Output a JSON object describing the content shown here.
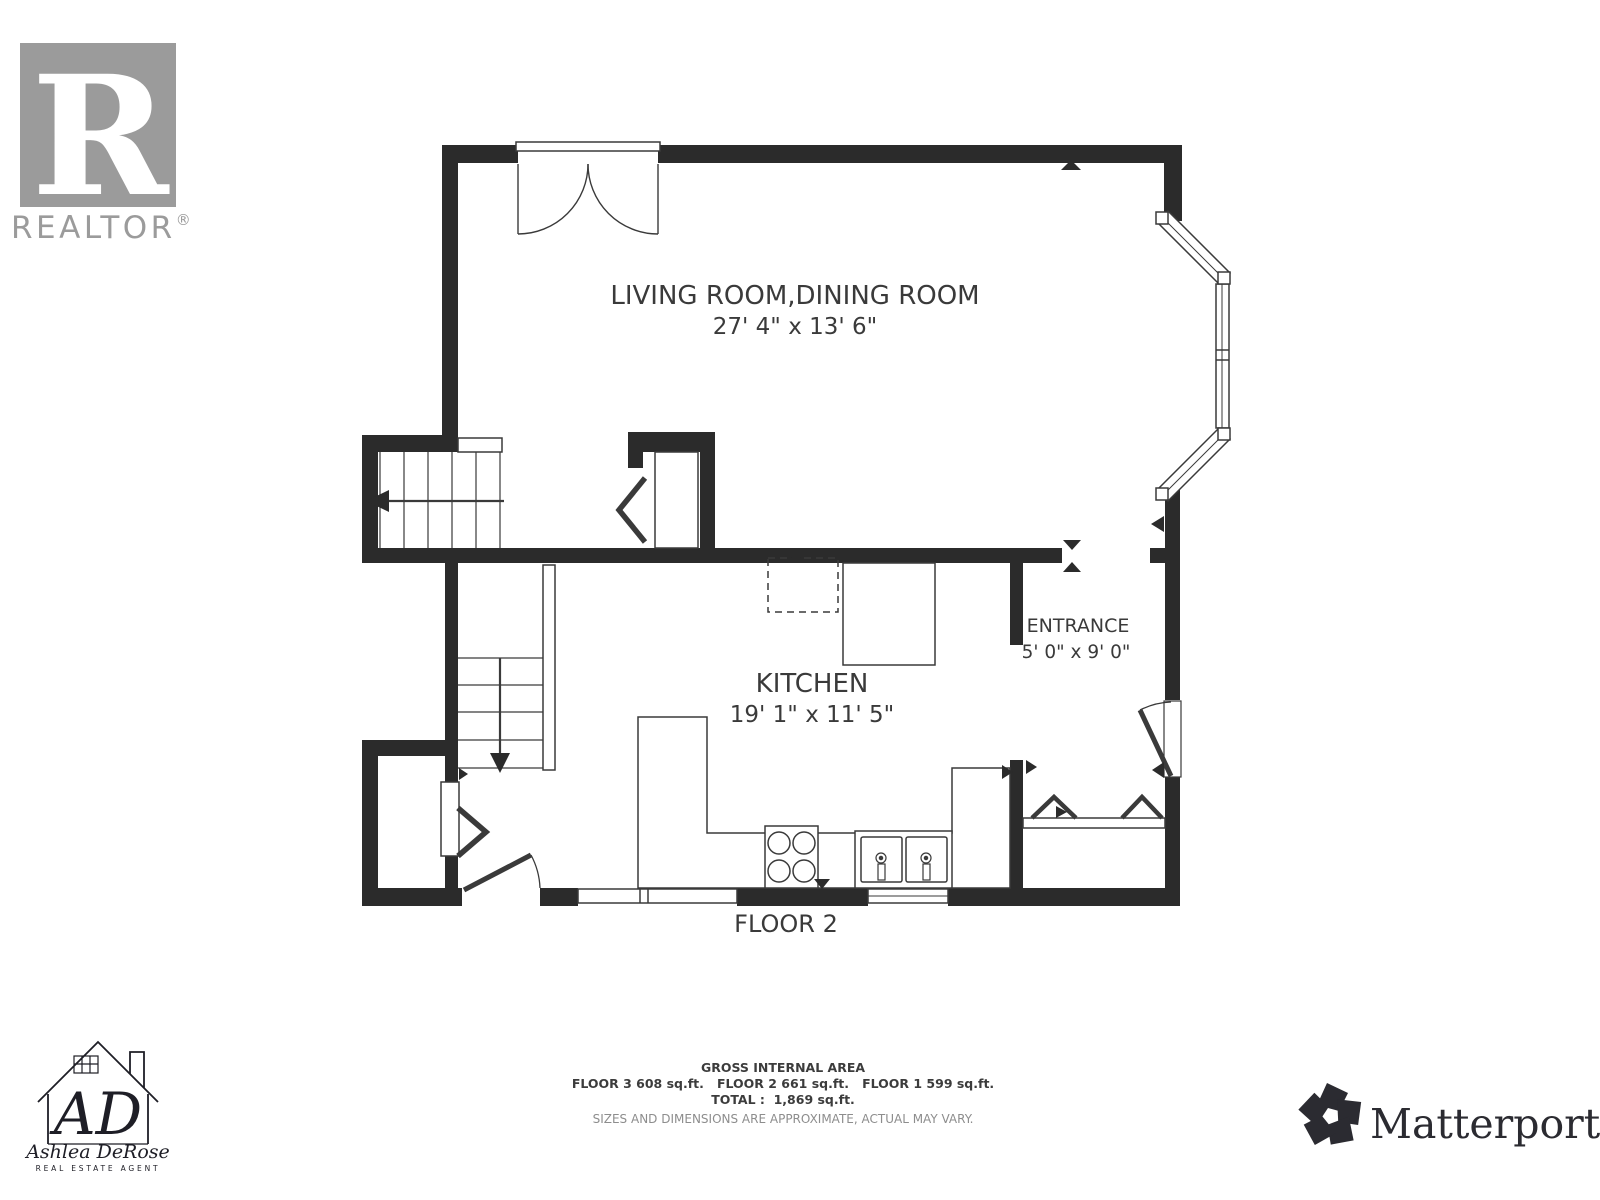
{
  "branding": {
    "realtor": {
      "mark_letter": "R",
      "wordmark": "REALTOR",
      "registered": "®"
    },
    "matterport": {
      "wordmark": "Matterport",
      "registered": "®"
    },
    "agent": {
      "monogram": "AD",
      "name": "Ashlea DeRose",
      "title": "REAL ESTATE AGENT"
    }
  },
  "floorplan": {
    "rooms": [
      {
        "name": "LIVING ROOM,DINING ROOM",
        "dimensions": "27' 4\" x 13' 6\""
      },
      {
        "name": "KITCHEN",
        "dimensions": "19' 1\" x 11' 5\""
      },
      {
        "name": "ENTRANCE",
        "dimensions": "5' 0\" x 9' 0\""
      }
    ],
    "floor_label": "FLOOR 2"
  },
  "footer": {
    "title": "GROSS INTERNAL AREA",
    "areas": "FLOOR 3 608 sq.ft.   FLOOR 2 661 sq.ft.   FLOOR 1 599 sq.ft.",
    "total": "TOTAL :  1,869 sq.ft.",
    "disclaimer": "SIZES AND DIMENSIONS ARE APPROXIMATE, ACTUAL MAY VARY."
  },
  "colors": {
    "wall": "#2b2b2b",
    "line": "#3a3a3a",
    "text": "#3a3a3a",
    "logo_gray": "#9b9b9b",
    "disclaimer_gray": "#8d8d8d",
    "matterport_dark": "#2b2b31",
    "agent_dark": "#1e1e26"
  }
}
